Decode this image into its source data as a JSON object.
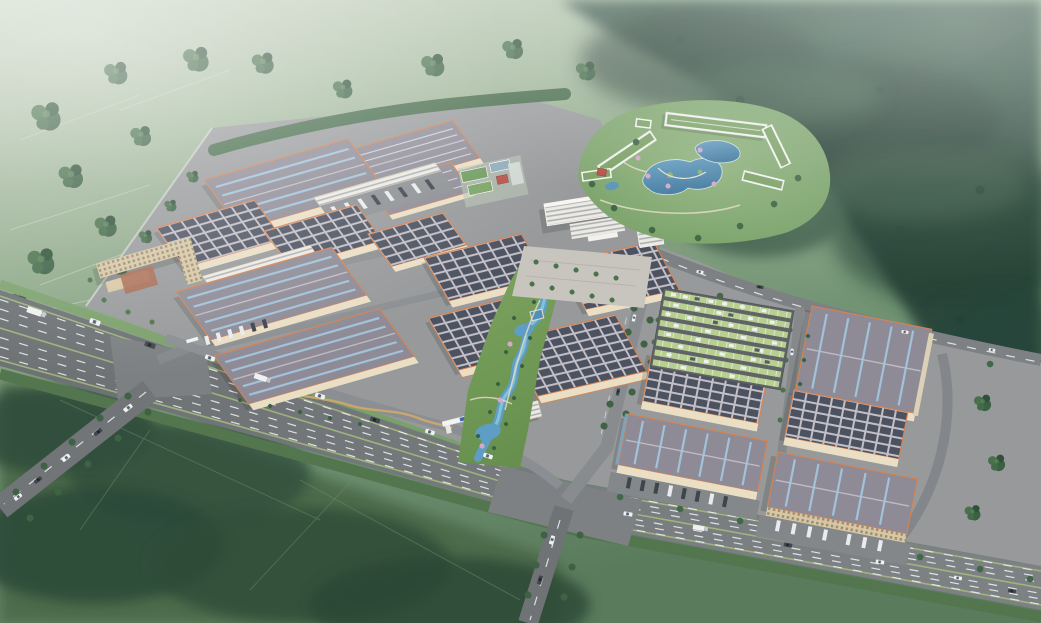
{
  "scene": {
    "title": "Aerial bird's-eye rendering of a logistics industrial park campus in a green valley",
    "type": "architectural-visualization",
    "view": "oblique aerial perspective, daytime, hazy",
    "features": [
      "rows of large gray-roof warehouses with blue skylight strips and orange trim",
      "warehouses with dark rooftop solar-panel grids",
      "central landscaped park with winding blue stream",
      "white office headquarters with forecourt plaza",
      "resort-style hotel ring with green roofs around ornamental lakes",
      "tan dormitory block with red courtyard",
      "surface parking lot with green grass-grid stalls and white cars",
      "loading dock aprons with parked truck trailers",
      "multi-lane highway with traffic and tree-lined verges",
      "branch roads, campus gates and perimeter wall",
      "forested hills and farmland fields surrounding the site"
    ]
  },
  "palette": {
    "mist": "#cfdacb",
    "field-light": "#a9bda0",
    "field-mid": "#7d9a78",
    "field-dark": "#4f6f4f",
    "forest": "#35523f",
    "forest-deep": "#22392e",
    "tree-green": "#3e6243",
    "asphalt": "#75797c",
    "asphalt-dark": "#5f6366",
    "lane-mark": "#e9edef",
    "campus-pave": "#97999b",
    "roof-gray": "#8e8b96",
    "roof-gray-dark": "#7b7885",
    "ridge-light": "#c3c0ca",
    "skylight-blue": "#a3c7de",
    "trim-orange": "#d9824d",
    "wall-cream": "#eadec5",
    "solar-dark": "#4d5260",
    "solar-frame": "#c2bfc6",
    "lake-blue": "#4e88ae",
    "stream-blue": "#5f9ec4",
    "lawn": "#7ca45e",
    "resort-roof": "#7fa368",
    "stall-green": "#b7d08f",
    "car-white": "#eef1f3",
    "truck-dark": "#42474e",
    "office-white": "#eceae2",
    "dorm-tan": "#d8c7a4",
    "court-red": "#aa6a52",
    "blossom-pink": "#d9a8c8",
    "wall-line": "#9fc0ca"
  }
}
